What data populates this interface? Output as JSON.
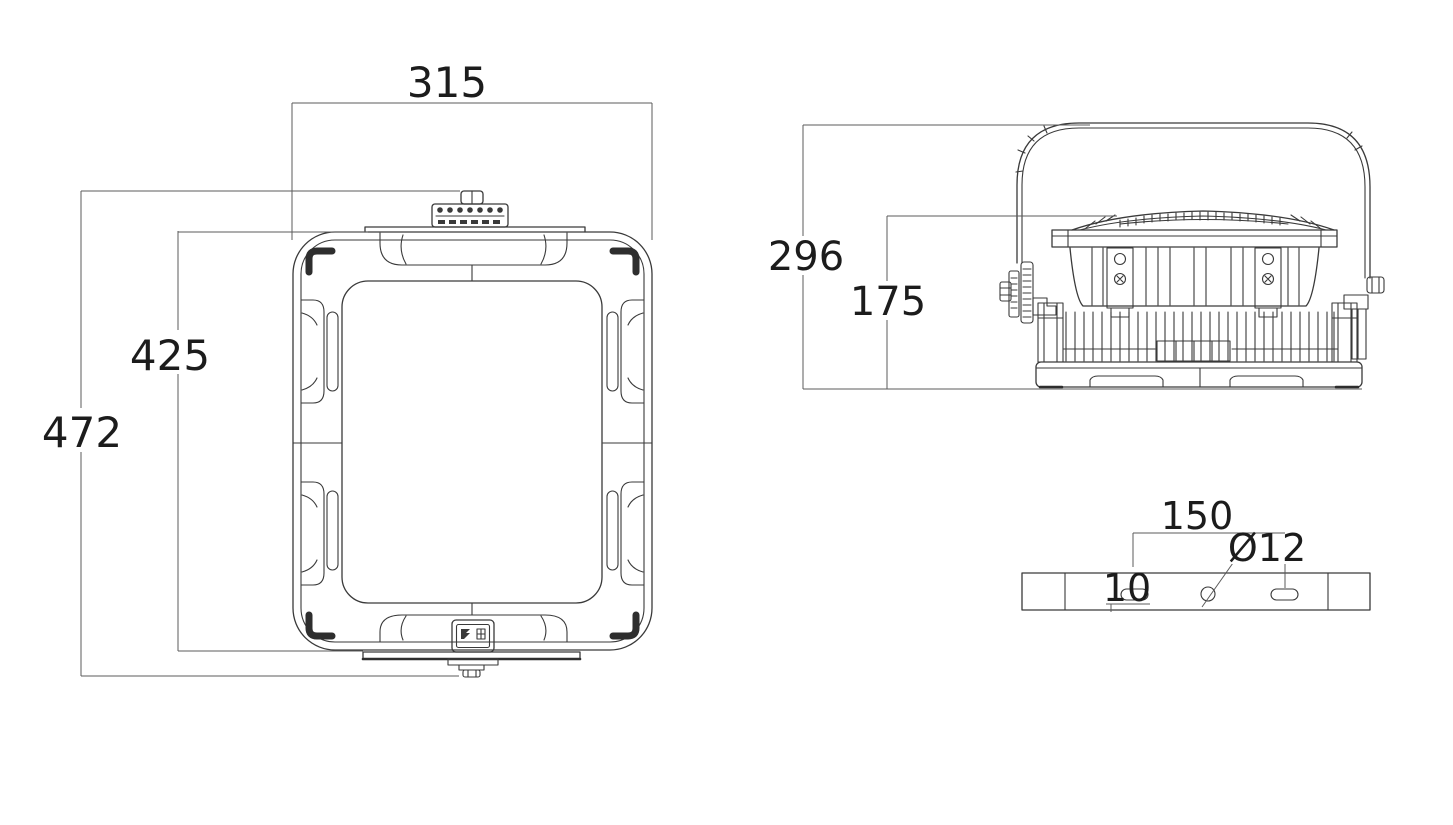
{
  "drawing": {
    "background": "#ffffff",
    "line_color": "#3a3a3a",
    "text_color": "#1c1c1c",
    "front_view": {
      "width_mm": "315",
      "mount_height_mm": "425",
      "overall_height_mm": "472"
    },
    "side_view": {
      "overall_depth_mm": "296",
      "body_depth_mm": "175"
    },
    "bracket_detail": {
      "hole_spacing_mm": "150",
      "slot_width_mm": "10",
      "hole_diameter": "Ø12"
    }
  }
}
